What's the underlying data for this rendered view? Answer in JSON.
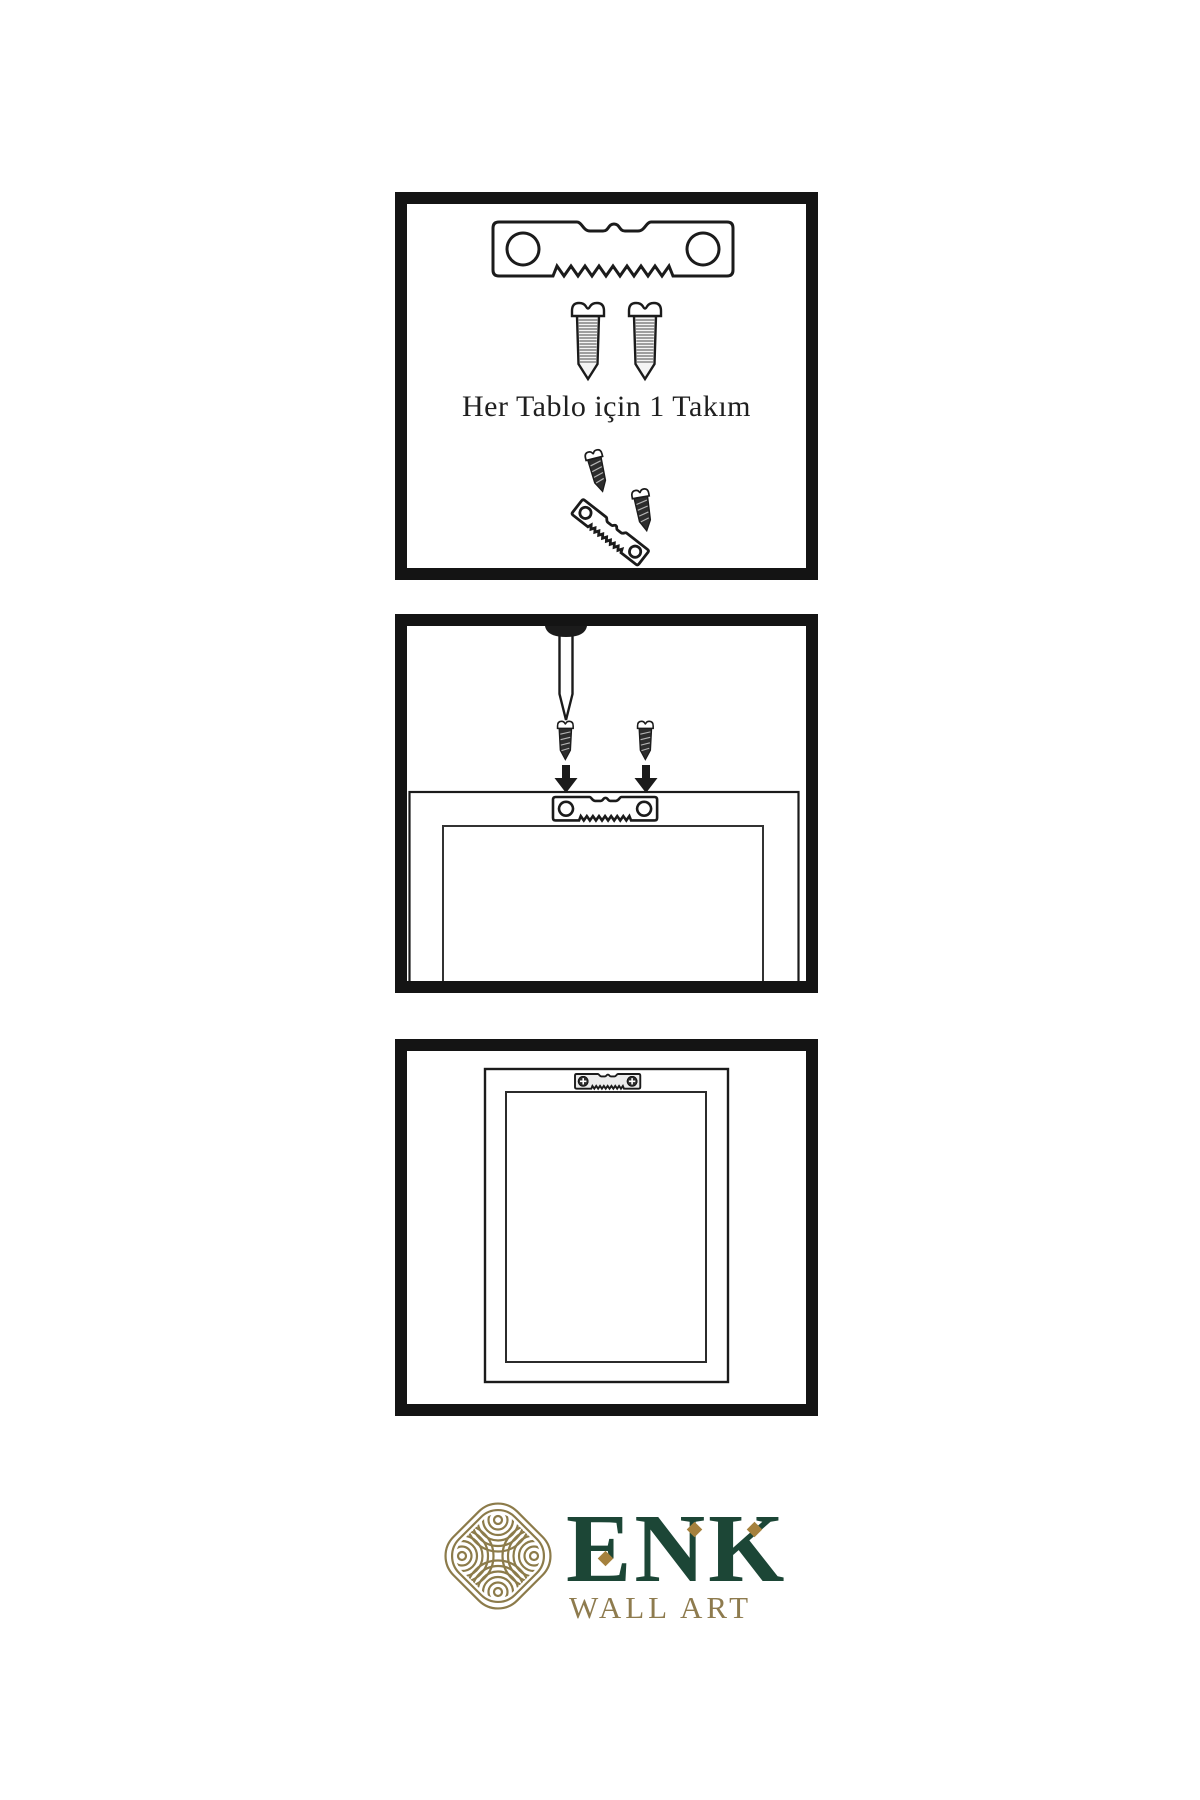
{
  "page": {
    "background": "#ffffff",
    "ink": "#1b1b1b"
  },
  "panels": {
    "kit": {
      "caption": "Her Tablo için 1 Takım",
      "items": [
        "sawtooth-hanger",
        "mounting-screw",
        "mounting-screw",
        "screws-into-tilted-hanger"
      ]
    },
    "attach": {
      "items": [
        "wall-nail",
        "mounting-screw",
        "mounting-screw",
        "down-arrow",
        "down-arrow",
        "frame-back-with-sawtooth-hanger"
      ]
    },
    "hang": {
      "items": [
        "hanging-frame",
        "mounted-sawtooth-hanger-with-screws"
      ]
    }
  },
  "brand": {
    "icon": "interwoven-knot-icon",
    "name": "ENK",
    "tagline": "WALL ART",
    "colors": {
      "green": "#1c4636",
      "gold": "#8e7b4e",
      "accent_gold": "#a5813d",
      "knot_gold": "#8c7b4a"
    }
  }
}
